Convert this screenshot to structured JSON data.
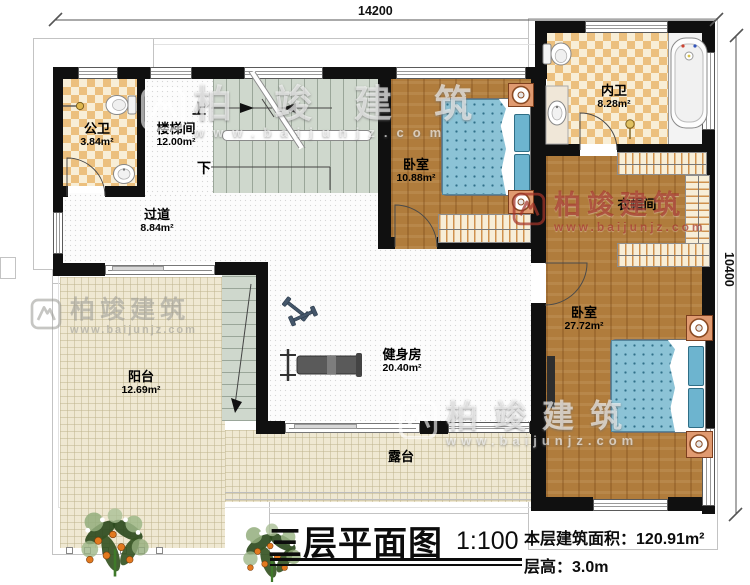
{
  "dimensions": {
    "top": "14200",
    "right": "10400"
  },
  "title_block": {
    "title": "三层平面图",
    "scale": "1:100",
    "area_label": "本层建筑面积：",
    "area_value": "120.91m²",
    "height_label": "层高：",
    "height_value": "3.0m"
  },
  "rooms": {
    "public_bath": {
      "name": "公卫",
      "area": "3.84m²"
    },
    "stairwell": {
      "name": "楼梯间",
      "area": "12.00m²"
    },
    "corridor": {
      "name": "过道",
      "area": "8.84m²"
    },
    "bedroom_small": {
      "name": "卧室",
      "area": "10.88m²"
    },
    "inner_bath": {
      "name": "内卫",
      "area": "8.28m²"
    },
    "cloakroom": {
      "name": "衣帽间"
    },
    "bedroom_master": {
      "name": "卧室",
      "area": "27.72m²"
    },
    "gym": {
      "name": "健身房",
      "area": "20.40m²"
    },
    "balcony": {
      "name": "阳台",
      "area": "12.69m²"
    },
    "terrace": {
      "name": "露台"
    }
  },
  "stairs": {
    "up": "上",
    "down": "下"
  },
  "watermark": {
    "brand": "柏竣建筑",
    "url": "www.baijunjz.com"
  }
}
